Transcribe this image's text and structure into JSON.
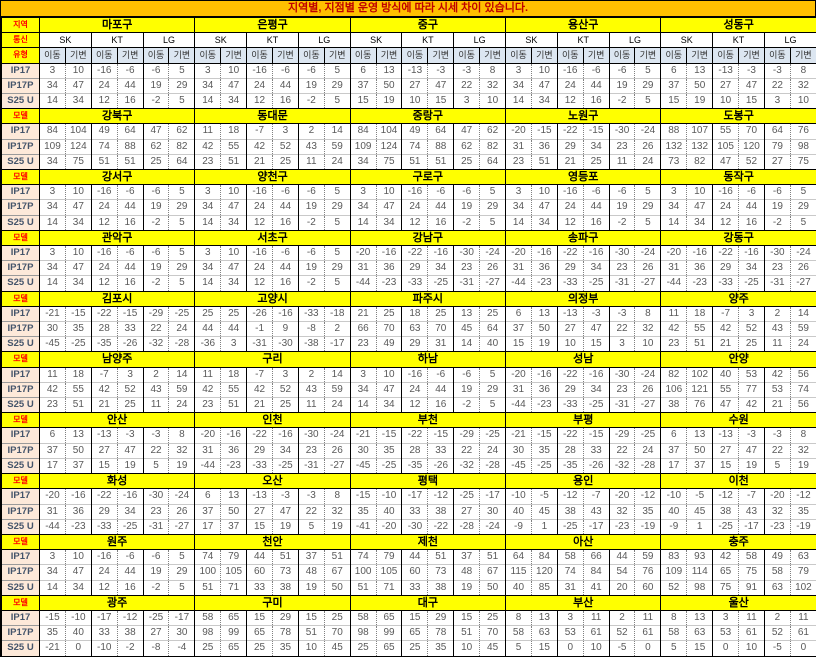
{
  "title": "지역별, 지점별 운영 방식에 따라 시세 차이 있습니다.",
  "corner_labels": {
    "region": "지역",
    "carrier": "통신",
    "type": "유형",
    "model": "모델"
  },
  "carriers": [
    "SK",
    "KT",
    "LG"
  ],
  "subtypes": [
    "이동",
    "기변"
  ],
  "models": [
    "IP17",
    "IP17P",
    "S25 U"
  ],
  "colors": {
    "title_bg": "#FFC000",
    "title_text": "#C00000",
    "region_bg": "#FFFF00",
    "corner_text": "#FF0000",
    "subtype_bg": "#DCE6F1",
    "model_bg": "#FDE9D9",
    "number_text": "#595959"
  },
  "blocks": [
    {
      "regions": [
        "마포구",
        "은평구",
        "중구",
        "용산구",
        "성동구"
      ],
      "rows": [
        [
          3,
          10,
          -16,
          -6,
          -6,
          5,
          3,
          10,
          -16,
          -6,
          -6,
          5,
          6,
          13,
          -13,
          -3,
          -3,
          8,
          3,
          10,
          -16,
          -6,
          -6,
          5,
          6,
          13,
          -13,
          -3,
          -3,
          8
        ],
        [
          34,
          47,
          24,
          44,
          19,
          29,
          34,
          47,
          24,
          44,
          19,
          29,
          37,
          50,
          27,
          47,
          22,
          32,
          34,
          47,
          24,
          44,
          19,
          29,
          37,
          50,
          27,
          47,
          22,
          32
        ],
        [
          14,
          34,
          12,
          16,
          -2,
          5,
          14,
          34,
          12,
          16,
          -2,
          5,
          15,
          19,
          10,
          15,
          3,
          10,
          14,
          34,
          12,
          16,
          -2,
          5,
          15,
          19,
          10,
          15,
          3,
          10
        ]
      ]
    },
    {
      "regions": [
        "강북구",
        "동대문",
        "중랑구",
        "노원구",
        "도봉구"
      ],
      "rows": [
        [
          84,
          104,
          49,
          64,
          47,
          62,
          11,
          18,
          -7,
          3,
          2,
          14,
          84,
          104,
          49,
          64,
          47,
          62,
          -20,
          -15,
          -22,
          -15,
          -30,
          -24,
          88,
          107,
          55,
          70,
          64,
          76
        ],
        [
          109,
          124,
          74,
          88,
          62,
          82,
          42,
          55,
          42,
          52,
          43,
          59,
          109,
          124,
          74,
          88,
          62,
          82,
          31,
          36,
          29,
          34,
          23,
          26,
          132,
          132,
          105,
          120,
          79,
          98
        ],
        [
          34,
          75,
          51,
          51,
          25,
          64,
          23,
          51,
          21,
          25,
          11,
          24,
          34,
          75,
          51,
          51,
          25,
          64,
          23,
          51,
          21,
          25,
          11,
          24,
          73,
          82,
          47,
          52,
          27,
          75
        ]
      ]
    },
    {
      "regions": [
        "강서구",
        "양천구",
        "구로구",
        "영등포",
        "동작구"
      ],
      "rows": [
        [
          3,
          10,
          -16,
          -6,
          -6,
          5,
          3,
          10,
          -16,
          -6,
          -6,
          5,
          3,
          10,
          -16,
          -6,
          -6,
          5,
          3,
          10,
          -16,
          -6,
          -6,
          5,
          3,
          10,
          -16,
          -6,
          -6,
          5
        ],
        [
          34,
          47,
          24,
          44,
          19,
          29,
          34,
          47,
          24,
          44,
          19,
          29,
          34,
          47,
          24,
          44,
          19,
          29,
          34,
          47,
          24,
          44,
          19,
          29,
          34,
          47,
          24,
          44,
          19,
          29
        ],
        [
          14,
          34,
          12,
          16,
          -2,
          5,
          14,
          34,
          12,
          16,
          -2,
          5,
          14,
          34,
          12,
          16,
          -2,
          5,
          14,
          34,
          12,
          16,
          -2,
          5,
          14,
          34,
          12,
          16,
          -2,
          5
        ]
      ]
    },
    {
      "regions": [
        "관악구",
        "서초구",
        "강남구",
        "송파구",
        "강동구"
      ],
      "rows": [
        [
          3,
          10,
          -16,
          -6,
          -6,
          5,
          3,
          10,
          -16,
          -6,
          -6,
          5,
          -20,
          -16,
          -22,
          -16,
          -30,
          -24,
          -20,
          -16,
          -22,
          -16,
          -30,
          -24,
          -20,
          -16,
          -22,
          -16,
          -30,
          -24
        ],
        [
          34,
          47,
          24,
          44,
          19,
          29,
          34,
          47,
          24,
          44,
          19,
          29,
          31,
          36,
          29,
          34,
          23,
          26,
          31,
          36,
          29,
          34,
          23,
          26,
          31,
          36,
          29,
          34,
          23,
          26
        ],
        [
          14,
          34,
          12,
          16,
          -2,
          5,
          14,
          34,
          12,
          16,
          -2,
          5,
          -44,
          -23,
          -33,
          -25,
          -31,
          -27,
          -44,
          -23,
          -33,
          -25,
          -31,
          -27,
          -44,
          -23,
          -33,
          -25,
          -31,
          -27
        ]
      ]
    },
    {
      "regions": [
        "김포시",
        "고양시",
        "파주시",
        "의정부",
        "양주"
      ],
      "rows": [
        [
          -21,
          -15,
          -22,
          -15,
          -29,
          -25,
          25,
          25,
          -26,
          -16,
          -33,
          -18,
          21,
          25,
          18,
          25,
          13,
          25,
          6,
          13,
          -13,
          -3,
          -3,
          8,
          11,
          18,
          -7,
          3,
          2,
          14
        ],
        [
          30,
          35,
          28,
          33,
          22,
          24,
          44,
          44,
          -1,
          9,
          -8,
          2,
          66,
          70,
          63,
          70,
          45,
          64,
          37,
          50,
          27,
          47,
          22,
          32,
          42,
          55,
          42,
          52,
          43,
          59
        ],
        [
          -45,
          -25,
          -35,
          -26,
          -32,
          -28,
          -36,
          3,
          -31,
          -30,
          -38,
          -17,
          23,
          49,
          29,
          31,
          14,
          40,
          15,
          19,
          10,
          15,
          3,
          10,
          23,
          51,
          21,
          25,
          11,
          24
        ]
      ]
    },
    {
      "regions": [
        "남양주",
        "구리",
        "하남",
        "성남",
        "안양"
      ],
      "rows": [
        [
          11,
          18,
          -7,
          3,
          2,
          14,
          11,
          18,
          -7,
          3,
          2,
          14,
          3,
          10,
          -16,
          -6,
          -6,
          5,
          -20,
          -16,
          -22,
          -16,
          -30,
          -24,
          82,
          102,
          40,
          53,
          42,
          56
        ],
        [
          42,
          55,
          42,
          52,
          43,
          59,
          42,
          55,
          42,
          52,
          43,
          59,
          34,
          47,
          24,
          44,
          19,
          29,
          31,
          36,
          29,
          34,
          23,
          26,
          106,
          121,
          55,
          77,
          53,
          74
        ],
        [
          23,
          51,
          21,
          25,
          11,
          24,
          23,
          51,
          21,
          25,
          11,
          24,
          14,
          34,
          12,
          16,
          -2,
          5,
          -44,
          -23,
          -33,
          -25,
          -31,
          -27,
          38,
          76,
          47,
          42,
          21,
          56
        ]
      ]
    },
    {
      "regions": [
        "안산",
        "인천",
        "부천",
        "부평",
        "수원"
      ],
      "rows": [
        [
          6,
          13,
          -13,
          -3,
          -3,
          8,
          -20,
          -16,
          -22,
          -16,
          -30,
          -24,
          -21,
          -15,
          -22,
          -15,
          -29,
          -25,
          -21,
          -15,
          -22,
          -15,
          -29,
          -25,
          6,
          13,
          -13,
          -3,
          -3,
          8
        ],
        [
          37,
          50,
          27,
          47,
          22,
          32,
          31,
          36,
          29,
          34,
          23,
          26,
          30,
          35,
          28,
          33,
          22,
          24,
          30,
          35,
          28,
          33,
          22,
          24,
          37,
          50,
          27,
          47,
          22,
          32
        ],
        [
          17,
          37,
          15,
          19,
          5,
          19,
          -44,
          -23,
          -33,
          -25,
          -31,
          -27,
          -45,
          -25,
          -35,
          -26,
          -32,
          -28,
          -45,
          -25,
          -35,
          -26,
          -32,
          -28,
          17,
          37,
          15,
          19,
          5,
          19
        ]
      ]
    },
    {
      "regions": [
        "화성",
        "오산",
        "평택",
        "용인",
        "이천"
      ],
      "rows": [
        [
          -20,
          -16,
          -22,
          -16,
          -30,
          -24,
          6,
          13,
          -13,
          -3,
          -3,
          8,
          -15,
          -10,
          -17,
          -12,
          -25,
          -17,
          -10,
          -5,
          -12,
          -7,
          -20,
          -12,
          -10,
          -5,
          -12,
          -7,
          -20,
          -12
        ],
        [
          31,
          36,
          29,
          34,
          23,
          26,
          37,
          50,
          27,
          47,
          22,
          32,
          35,
          40,
          33,
          38,
          27,
          30,
          40,
          45,
          38,
          43,
          32,
          35,
          40,
          45,
          38,
          43,
          32,
          35
        ],
        [
          -44,
          -23,
          -33,
          -25,
          -31,
          -27,
          17,
          37,
          15,
          19,
          5,
          19,
          -41,
          -20,
          -30,
          -22,
          -28,
          -24,
          -9,
          1,
          -25,
          -17,
          -23,
          -19,
          -9,
          1,
          -25,
          -17,
          -23,
          -19
        ]
      ]
    },
    {
      "regions": [
        "원주",
        "천안",
        "제천",
        "아산",
        "충주"
      ],
      "rows": [
        [
          3,
          10,
          -16,
          -6,
          -6,
          5,
          74,
          79,
          44,
          51,
          37,
          51,
          74,
          79,
          44,
          51,
          37,
          51,
          64,
          84,
          58,
          66,
          44,
          59,
          83,
          93,
          42,
          58,
          49,
          63
        ],
        [
          34,
          47,
          24,
          44,
          19,
          29,
          100,
          105,
          60,
          73,
          48,
          67,
          100,
          105,
          60,
          73,
          48,
          67,
          115,
          120,
          74,
          84,
          54,
          76,
          109,
          114,
          65,
          75,
          58,
          79
        ],
        [
          14,
          34,
          12,
          16,
          -2,
          5,
          51,
          71,
          33,
          38,
          19,
          50,
          51,
          71,
          33,
          38,
          19,
          50,
          40,
          85,
          31,
          41,
          20,
          60,
          52,
          98,
          75,
          91,
          63,
          102
        ]
      ]
    },
    {
      "regions": [
        "광주",
        "구미",
        "대구",
        "부산",
        "울산"
      ],
      "rows": [
        [
          -15,
          -10,
          -17,
          -12,
          -25,
          -17,
          58,
          65,
          15,
          29,
          15,
          25,
          58,
          65,
          15,
          29,
          15,
          25,
          8,
          13,
          3,
          11,
          2,
          11,
          8,
          13,
          3,
          11,
          2,
          11
        ],
        [
          35,
          40,
          33,
          38,
          27,
          30,
          98,
          99,
          65,
          78,
          51,
          70,
          98,
          99,
          65,
          78,
          51,
          70,
          58,
          63,
          53,
          61,
          52,
          61,
          58,
          63,
          53,
          61,
          52,
          61
        ],
        [
          -21,
          0,
          -10,
          -2,
          -8,
          -4,
          25,
          65,
          25,
          35,
          10,
          45,
          25,
          65,
          25,
          35,
          10,
          45,
          5,
          15,
          0,
          10,
          -5,
          0,
          5,
          15,
          0,
          10,
          -5,
          0
        ]
      ]
    }
  ]
}
